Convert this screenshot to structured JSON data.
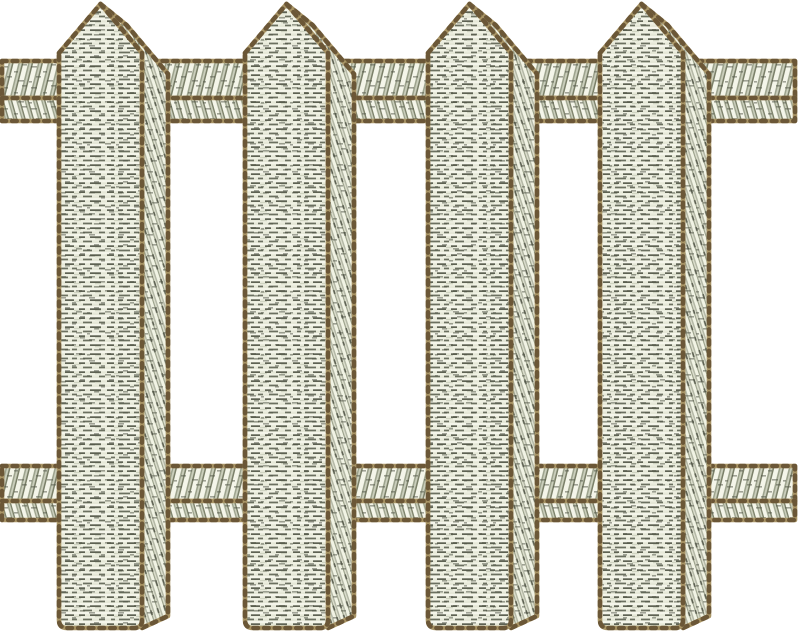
{
  "meta": {
    "subject": "white-picket-fence-machine-embroidery-design",
    "background": "#ffffff",
    "width": 800,
    "height": 635
  },
  "palette": {
    "thread_base": "#e6e8d8",
    "thread_light": "#f4f5ea",
    "thread_row2": "#f0f2e4",
    "thread_mid": "#c7cbb8",
    "thread_shadow": "#9aa08a",
    "thread_dark": "#5e6253",
    "thread_dark2": "#6b7060",
    "speckle": "#4e5244",
    "rail_light": "#f4f5e9",
    "rail_bg": "#eef0e1",
    "rail_mid": "#ccd0bd",
    "rail_deep": "#7b8069",
    "side_bg": "#e8ead9",
    "side_light": "#f1f3e4",
    "side_mid": "#b4b8a6",
    "side_pale": "#dfe1d0",
    "outline_tan": "#a99566",
    "outline_brown": "#6b5737"
  },
  "fence": {
    "picket_count": 4,
    "rail_count": 2,
    "pickets": [
      {
        "name": "picket-1",
        "x": 59
      },
      {
        "name": "picket-2",
        "x": 245
      },
      {
        "name": "picket-3",
        "x": 428
      },
      {
        "name": "picket-4",
        "x": 600
      }
    ],
    "picket_shape": {
      "main_width": 83,
      "side_offset_x": 26,
      "side_offset_y": 21,
      "apex_y": 4,
      "shoulder_y": 53,
      "bottom_y": 628,
      "side_bottom_inset": 12,
      "corner_radius": 8
    },
    "rails": [
      {
        "name": "top-rail",
        "bands": [
          {
            "y": 61,
            "height": 37
          },
          {
            "y": 98,
            "height": 23
          }
        ]
      },
      {
        "name": "bottom-rail",
        "bands": [
          {
            "y": 466,
            "height": 35
          },
          {
            "y": 501,
            "height": 19
          }
        ]
      }
    ],
    "rail_x": 2,
    "rail_width": 793,
    "stitch": {
      "outline_width": 4.6,
      "dash": "4.5 6.2",
      "row_height": 4.5
    }
  }
}
